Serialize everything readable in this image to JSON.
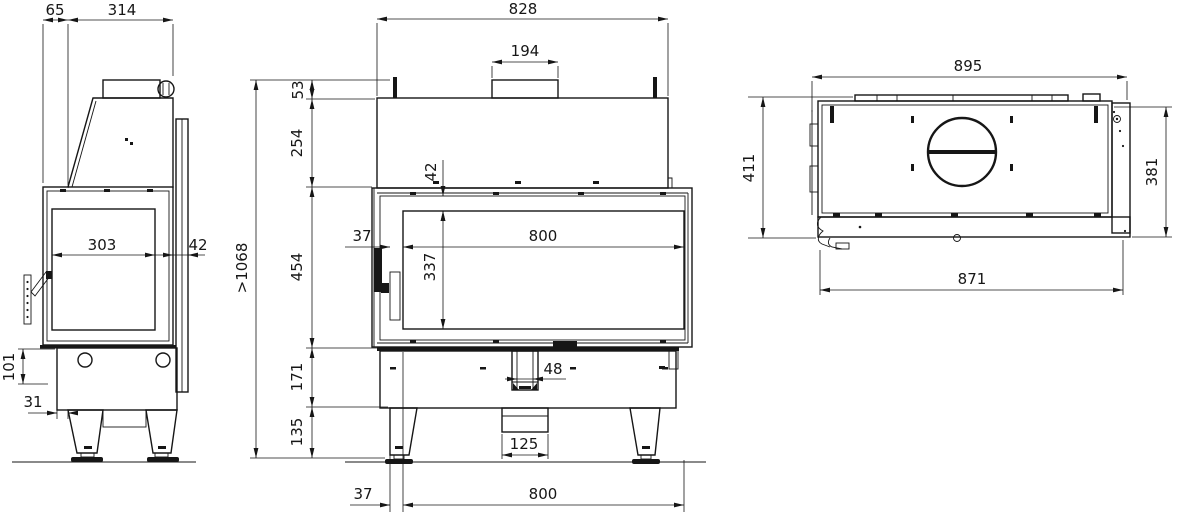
{
  "meta": {
    "drawing_type": "fireplace-insert-three-view-dimension-drawing",
    "units": "mm"
  },
  "colors": {
    "line": "#161616",
    "background": "#ffffff"
  },
  "views": {
    "side": {
      "label": "side-view",
      "dims": {
        "flue_offset": "65",
        "top_depth": "314",
        "glass_width": "303",
        "frame_depth": "42",
        "base_height": "101",
        "leg_inset": "31"
      }
    },
    "front": {
      "label": "front-view",
      "dims": {
        "overall_width": "828",
        "flue_collar_width": "194",
        "bracket_height": "53",
        "hood_height": "254",
        "door_height": "454",
        "base_height": "171",
        "leg_height": "135",
        "min_total_height": ">1068",
        "glass_top_inset": "42",
        "glass_height": "337",
        "side_inset": "37",
        "glass_width": "800",
        "air_inlet_width": "48",
        "duct_width": "125",
        "floor_side_inset": "37",
        "floor_opening_width": "800"
      }
    },
    "top": {
      "label": "top-view",
      "dims": {
        "overall_width": "895",
        "overall_depth": "411",
        "body_depth": "381",
        "front_frame_width": "871"
      }
    }
  }
}
